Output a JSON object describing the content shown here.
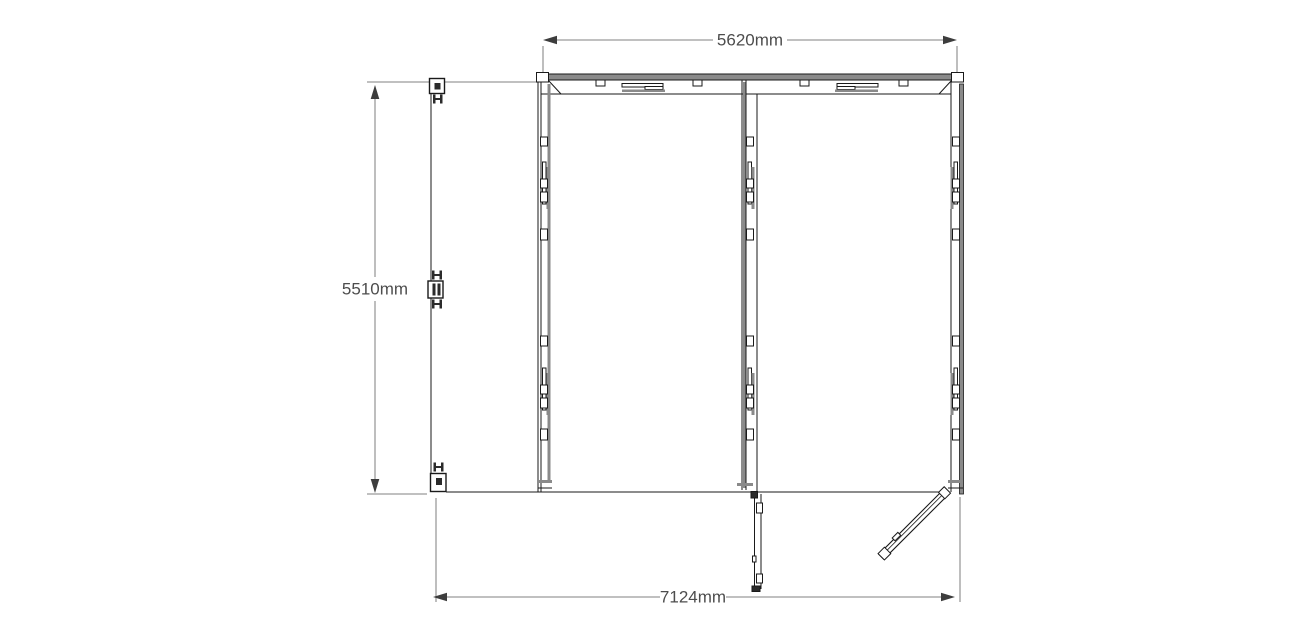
{
  "diagram": {
    "type": "floor-plan",
    "units": "mm",
    "dimensions": [
      {
        "side": "top",
        "label": "5620mm",
        "value_mm": 5620
      },
      {
        "side": "left",
        "label": "5510mm",
        "value_mm": 5510
      },
      {
        "side": "bottom",
        "label": "7124mm",
        "value_mm": 7124
      }
    ],
    "structure": {
      "bays": 2,
      "doors": [
        {
          "name": "left-side-door-open-90deg",
          "hinges": 3,
          "hinge_symbol": "H"
        },
        {
          "name": "front-door-leaf-open-down"
        },
        {
          "name": "front-door-leaf-open-45deg"
        }
      ]
    },
    "colors": {
      "background": "#ffffff",
      "line": "#1a1a1a",
      "wall_gray": "#8a8a8a",
      "dim_line": "#9b9b9b",
      "dim_arrow": "#3d3d3d",
      "dim_text": "#4d4d4d"
    }
  }
}
